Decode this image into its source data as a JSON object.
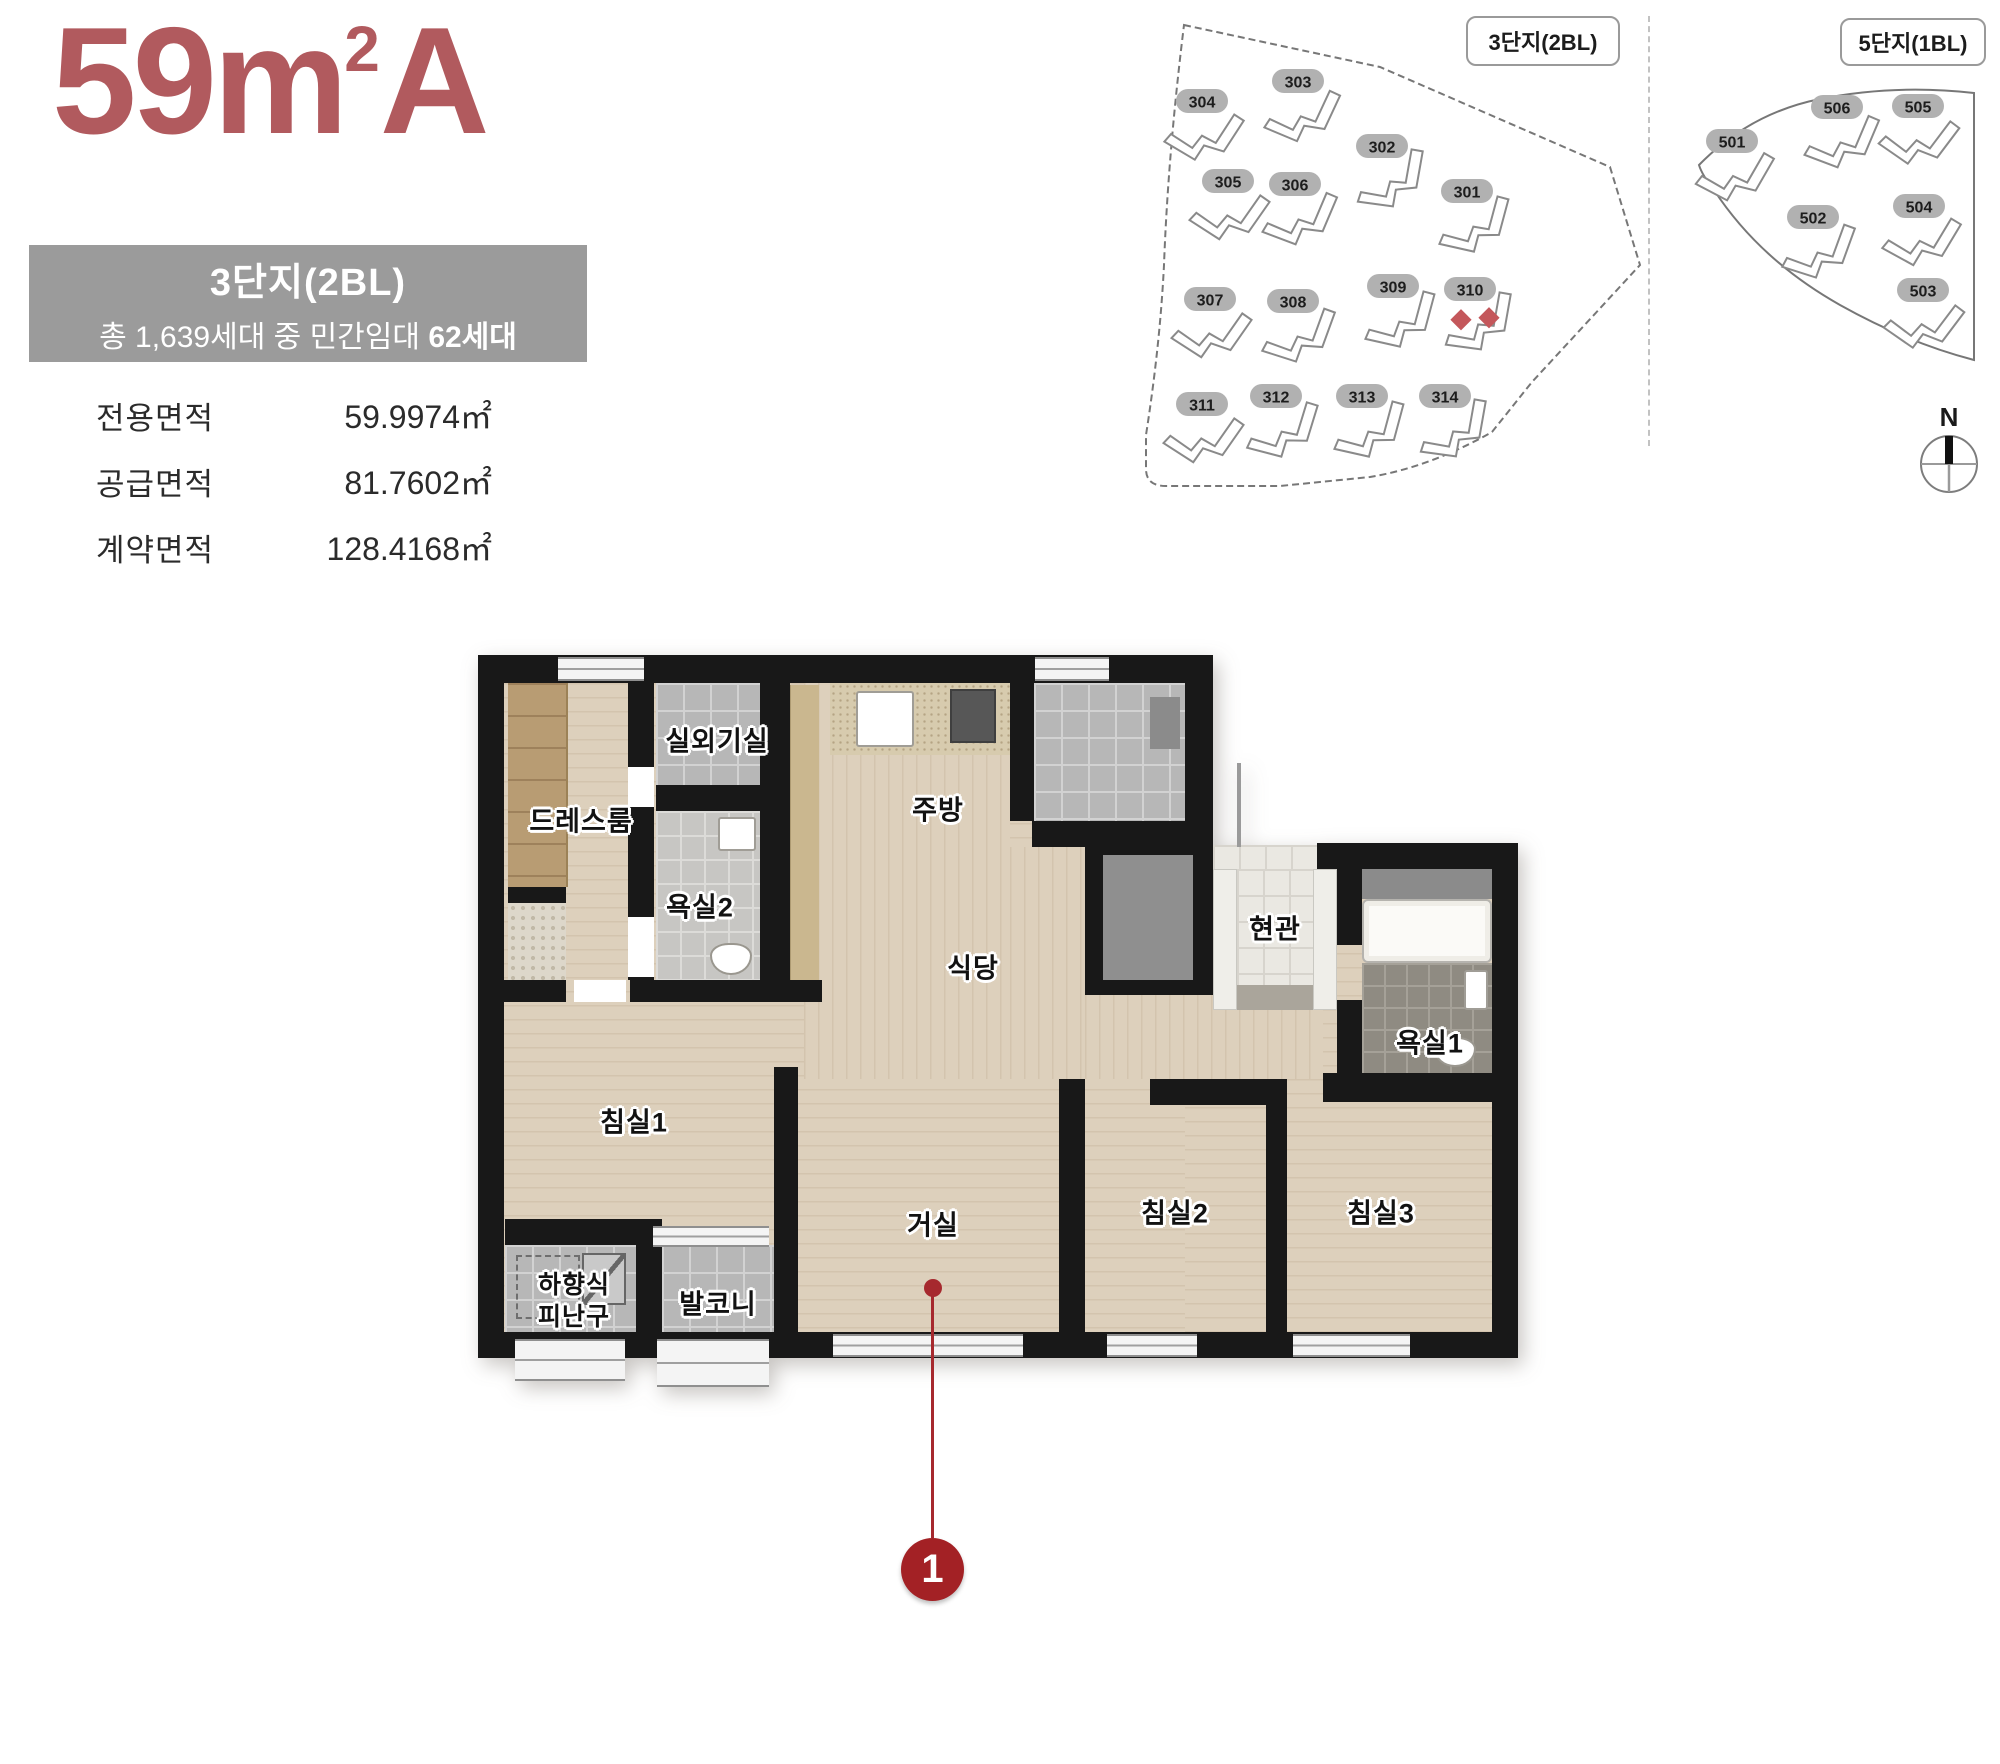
{
  "header": {
    "title": {
      "number": "59",
      "unit": "m",
      "sup": "2",
      "suffix": "A"
    },
    "complex_box": {
      "line1": "3단지(2BL)",
      "line2_prefix": "총 1,639세대 중 민간임대 ",
      "line2_bold": "62세대"
    },
    "area_table": {
      "rows": [
        {
          "label": "전용면적",
          "value": "59.9974㎡"
        },
        {
          "label": "공급면적",
          "value": "81.7602㎡"
        },
        {
          "label": "계약면적",
          "value": "128.4168㎡"
        }
      ]
    }
  },
  "site_maps": {
    "map1": {
      "title": "3단지(2BL)",
      "highlight_building": "310",
      "buildings": [
        {
          "id": "303",
          "x": 168,
          "y": 77,
          "rot": -20
        },
        {
          "id": "304",
          "x": 72,
          "y": 97,
          "rot": -12
        },
        {
          "id": "302",
          "x": 252,
          "y": 142,
          "rot": -35
        },
        {
          "id": "305",
          "x": 98,
          "y": 177,
          "rot": -10
        },
        {
          "id": "306",
          "x": 165,
          "y": 180,
          "rot": -22
        },
        {
          "id": "301",
          "x": 337,
          "y": 187,
          "rot": -30
        },
        {
          "id": "307",
          "x": 80,
          "y": 295,
          "rot": -10
        },
        {
          "id": "308",
          "x": 163,
          "y": 297,
          "rot": -25
        },
        {
          "id": "309",
          "x": 263,
          "y": 282,
          "rot": -30
        },
        {
          "id": "310",
          "x": 340,
          "y": 285,
          "rot": -35
        },
        {
          "id": "311",
          "x": 72,
          "y": 400,
          "rot": -10
        },
        {
          "id": "312",
          "x": 146,
          "y": 392,
          "rot": -28
        },
        {
          "id": "313",
          "x": 232,
          "y": 392,
          "rot": -30
        },
        {
          "id": "314",
          "x": 315,
          "y": 392,
          "rot": -35
        }
      ]
    },
    "map2": {
      "title": "5단지(1BL)",
      "buildings": [
        {
          "id": "501",
          "x": 42,
          "y": 137,
          "rot": -15
        },
        {
          "id": "506",
          "x": 147,
          "y": 103,
          "rot": -22
        },
        {
          "id": "505",
          "x": 228,
          "y": 102,
          "rot": -8
        },
        {
          "id": "502",
          "x": 123,
          "y": 213,
          "rot": -25
        },
        {
          "id": "504",
          "x": 229,
          "y": 202,
          "rot": -14
        },
        {
          "id": "503",
          "x": 233,
          "y": 286,
          "rot": -8
        }
      ]
    },
    "compass_label": "N"
  },
  "floor_plan": {
    "labels": {
      "outdoor_unit": "실외기실",
      "dress": "드레스룸",
      "kitchen": "주방",
      "bath2": "욕실2",
      "dining": "식당",
      "entry": "현관",
      "bath1": "욕실1",
      "bed1": "침실1",
      "living": "거실",
      "bed2": "침실2",
      "bed3": "침실3",
      "hatch_line1": "하향식",
      "hatch_line2": "피난구",
      "balcony": "발코니"
    },
    "marker": {
      "number": "1"
    }
  },
  "colors": {
    "accent_maroon": "#b15a5e",
    "complex_box_gray": "#9b9b9b",
    "marker_red": "#a32125",
    "map_highlight_red": "#c4575b",
    "wall_black": "#181818",
    "wood_floor": "#ddd0bc",
    "tile_gray": "#b7b7b7"
  }
}
